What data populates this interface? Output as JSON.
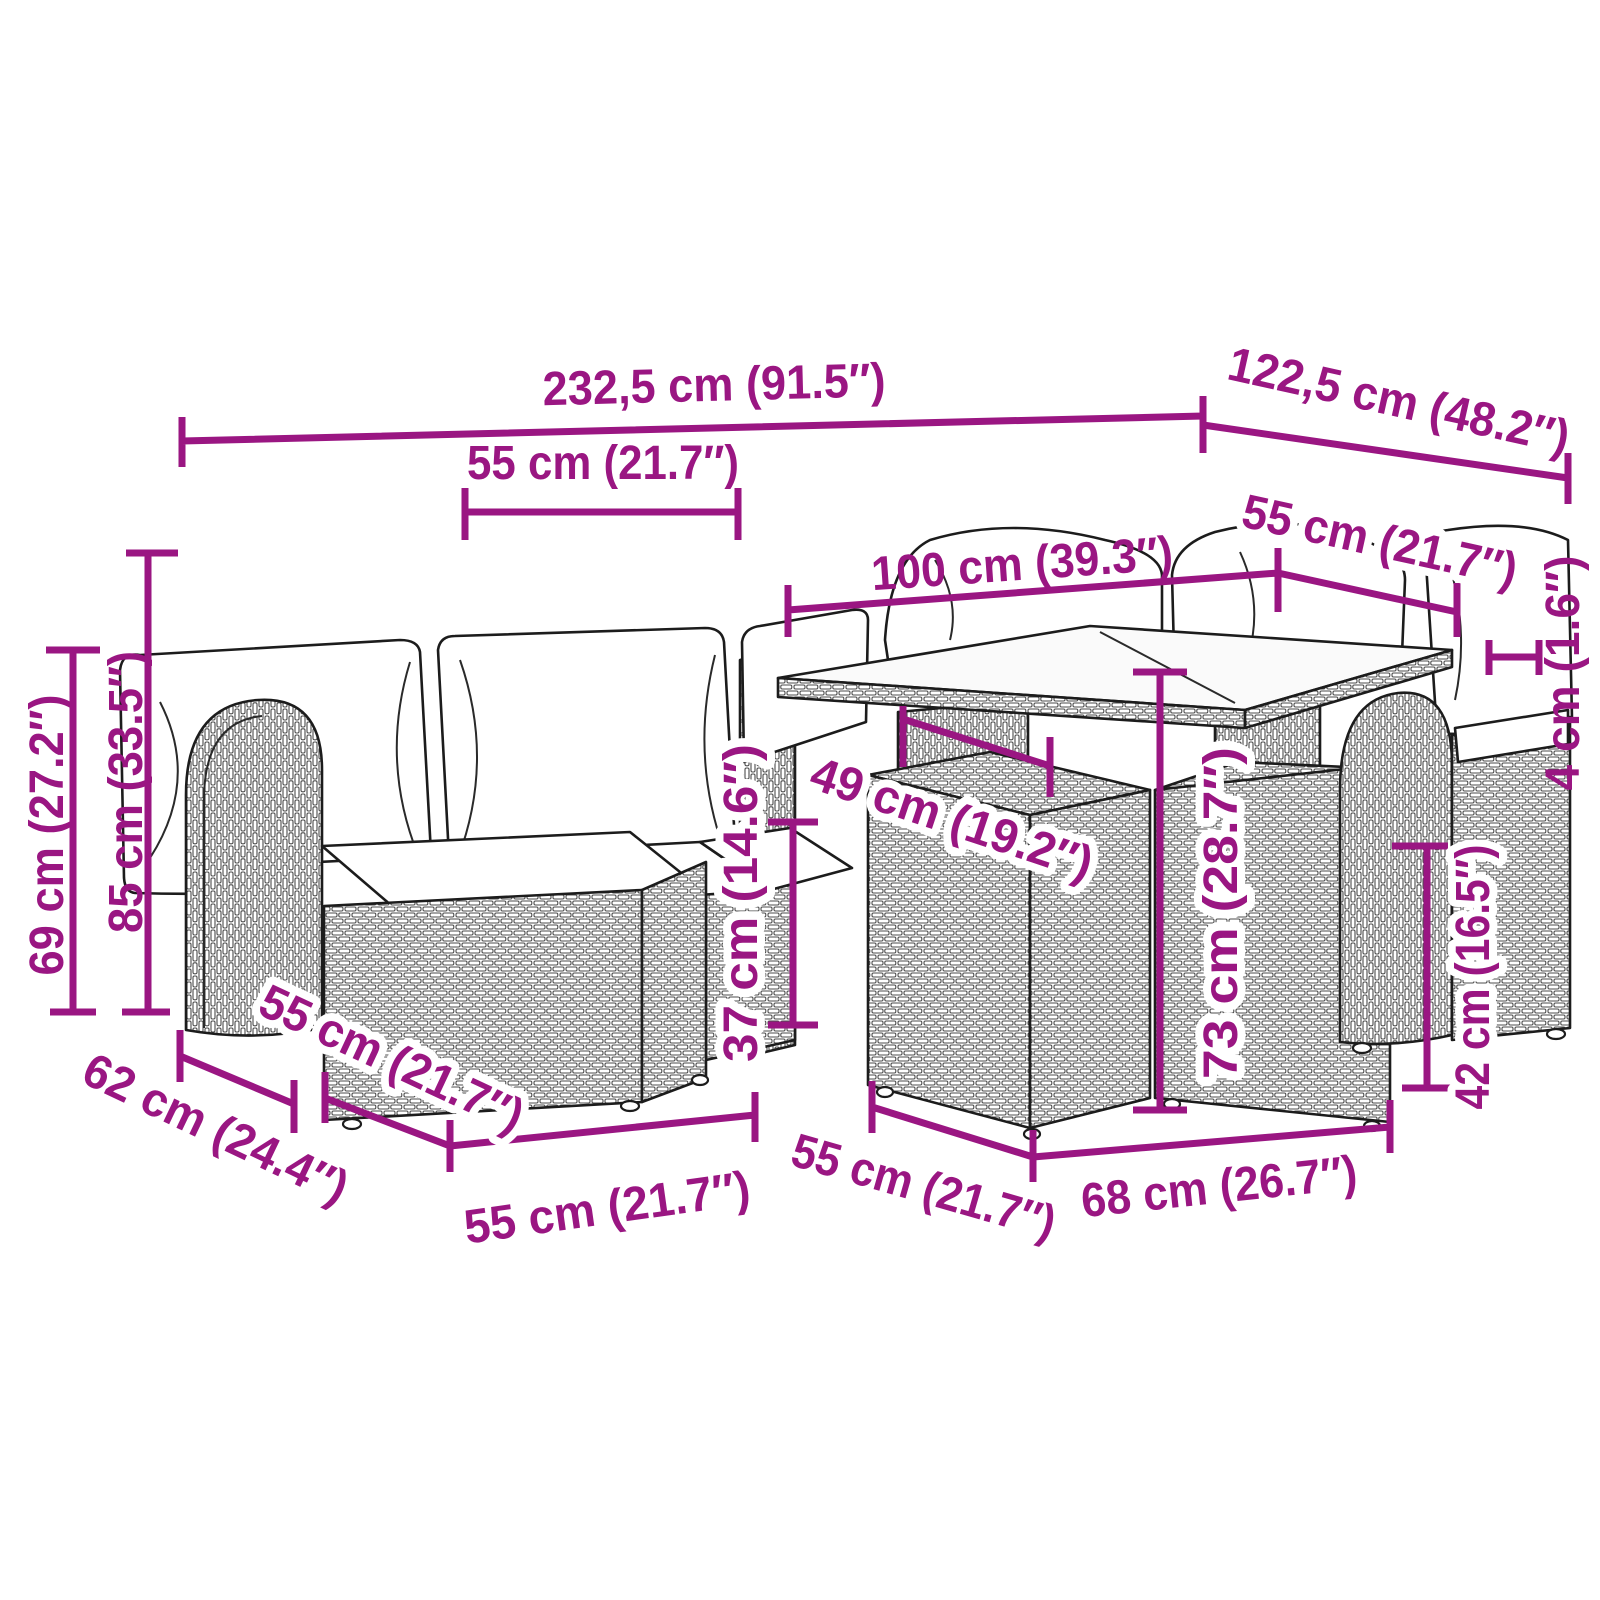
{
  "colors": {
    "accent": "#9A1682",
    "linework": "#1c1c1c",
    "background": "#ffffff"
  },
  "diagram": {
    "type": "furniture-dimension-diagram",
    "units": [
      "cm",
      "inches"
    ]
  },
  "dimensions": {
    "overall_width": "232,5 cm (91.5″)",
    "overall_depth": "122,5 cm (48.2″)",
    "back_cushion_width": "55 cm (21.7″)",
    "table_length": "100 cm (39.3″)",
    "table_depth": "55 cm (21.7″)",
    "overall_height": "85 cm (33.5″)",
    "armrest_height": "69 cm (27.2″)",
    "seat_height": "37 cm (14.6″)",
    "seat_depth": "49 cm (19.2″)",
    "table_height": "73 cm (28.7″)",
    "tabletop_thickness": "4 cm (1.6″)",
    "stool_height": "42 cm (16.5″)",
    "sofa_depth": "62 cm (24.4″)",
    "ottoman_depth": "55 cm (21.7″)",
    "ottoman_width": "55 cm (21.7″)",
    "stool_depth": "55 cm (21.7″)",
    "stool_width": "68 cm (26.7″)"
  }
}
